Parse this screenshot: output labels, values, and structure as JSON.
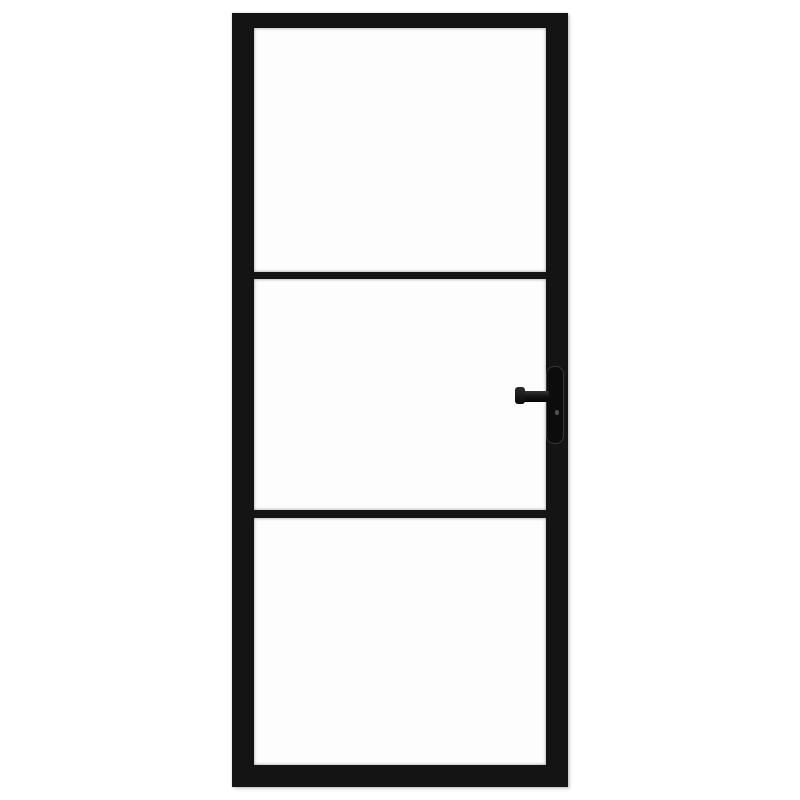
{
  "scene": {
    "type": "product-photo",
    "description": "Black metal-framed interior glass door with three clear glass panels, two horizontal muntin bars and a black lever handle on the right stile",
    "background_color": "#ffffff"
  },
  "door": {
    "frame_color": "#141414",
    "glass_color": "#fdfdfd",
    "muntin_color": "#161616",
    "panel_count": 3,
    "muntin_count": 2
  },
  "handle": {
    "side": "right",
    "backplate_color": "#0c0c0c",
    "backplate_outline_color": "#383838",
    "lever_color": "#1c1c1c",
    "keyhole_color": "#4f4f4f"
  }
}
